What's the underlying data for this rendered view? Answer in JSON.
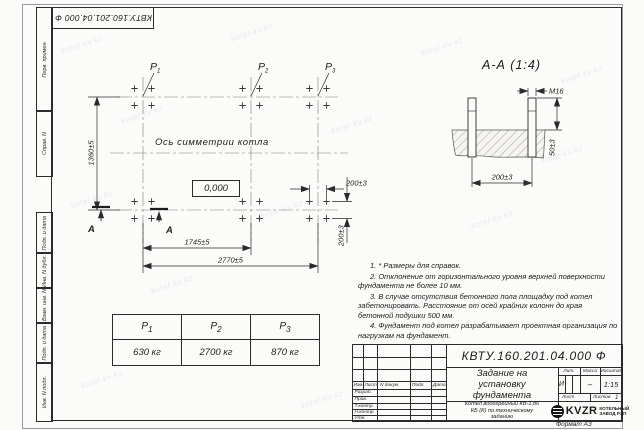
{
  "watermark": {
    "text": "kotel-kv.kz"
  },
  "top_stamp": {
    "text": "КВТУ.160.201.04.000 Ф"
  },
  "side_columns": {
    "top": [
      "Перв. примен.",
      "Справ. N"
    ],
    "bottom": [
      "Подп. и дата",
      "Инв. N дубл.",
      "Взам. инв. N",
      "Подп. и дата",
      "Инв. N подл."
    ]
  },
  "plan": {
    "p_labels": [
      {
        "name": "P",
        "sub": "1"
      },
      {
        "name": "P",
        "sub": "2"
      },
      {
        "name": "P",
        "sub": "3"
      }
    ],
    "symmetry_text": "Ось симметрии котла",
    "level_mark": "0,000",
    "section_letter": "А",
    "dims": {
      "height": "1360±5",
      "span_mid": "1745±5",
      "span_full": "2770±5",
      "bolt_spacing_x": "200±3",
      "bolt_spacing_y": "200±3"
    }
  },
  "section_view": {
    "title": "А-А (1:4)",
    "dims": {
      "thread": "М16",
      "protrusion": "50±3",
      "spacing": "200±3"
    }
  },
  "load_table": {
    "headers": [
      {
        "name": "P",
        "sub": "1"
      },
      {
        "name": "P",
        "sub": "2"
      },
      {
        "name": "P",
        "sub": "3"
      }
    ],
    "values": [
      "630 кг",
      "2700 кг",
      "870 кг"
    ]
  },
  "notes": [
    "1. * Размеры для справок.",
    "2. Отклонение от горизонтального уровня верхней поверхности фундамента не более 10 мм.",
    "3. В случае отсутствия бетонного пола площадку под котел забетонировать. Расстояние от осей крайних колонн до края бетонной подушки 500 мм.",
    "4. Фундамент под котел разрабатывает проектная организация по нагрузкам на фундамент."
  ],
  "title_block": {
    "doc_number": "КВТУ.160.201.04.000 Ф",
    "title": "Задание на установку фундамента",
    "subtitle": "Котел водогрейный КВ-1,86 КБ (К) по техническому заданию",
    "header_cols": [
      "Изм.",
      "Лист",
      "N докум.",
      "Подп.",
      "Дата"
    ],
    "staff_rows": [
      "Разраб.",
      "Пров.",
      "Т.контр.",
      "Н.контр.",
      "Утв."
    ],
    "lit": {
      "label": "Лит.",
      "value": "И"
    },
    "mass": {
      "label": "Масса",
      "value": "–"
    },
    "scale": {
      "label": "Масштаб",
      "value": "1:15"
    },
    "sheet": {
      "label": "Лист",
      "total_label": "Листов",
      "total_value": "1"
    },
    "company": {
      "logo": "KVZR",
      "line1": "КОТЕЛЬНЫЙ",
      "line2": "ЗАВОД РЭП"
    },
    "format_note": "Формат А3"
  }
}
